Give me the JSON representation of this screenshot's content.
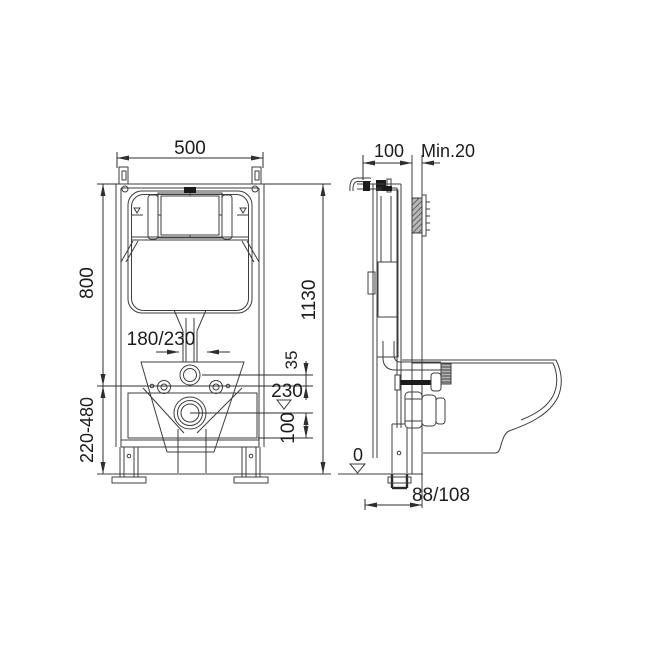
{
  "drawing": {
    "front_view": {
      "frame_width": "500",
      "frame_height": "800",
      "leg_adjust_range": "220-480",
      "overall_height": "1130",
      "bolt_spacing": "180/230",
      "flush_to_axis": "35",
      "outlet_level": "230",
      "outlet_drop": "100"
    },
    "side_view": {
      "frame_depth": "100",
      "wall_min_thickness": "Min.20",
      "floor_level": "0",
      "outlet_offset": "88/108"
    },
    "colors": {
      "line": "#3d3d3d",
      "dim_text": "#1c1c1c",
      "dark_fill": "#1b1b1b",
      "background": "#ffffff"
    }
  }
}
